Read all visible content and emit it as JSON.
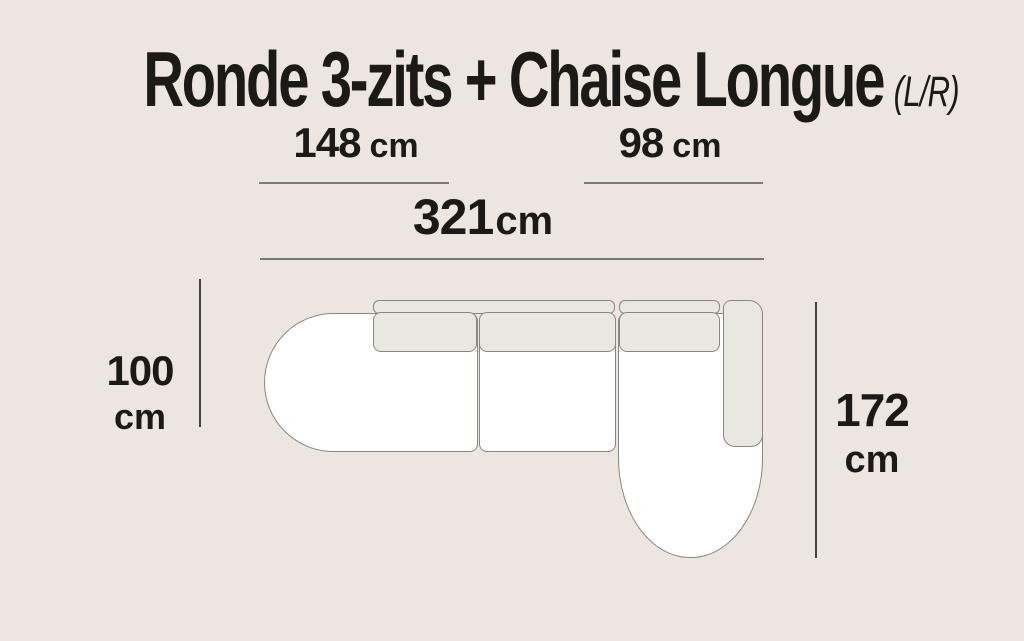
{
  "title": {
    "main": "Ronde 3-zits + Chaise Longue",
    "suffix": "(L/R)"
  },
  "measurements": {
    "left_section_width": {
      "value": "148",
      "unit": "cm"
    },
    "chaise_section_width": {
      "value": "98",
      "unit": "cm"
    },
    "total_width": {
      "value": "321",
      "unit": "cm"
    },
    "sofa_depth": {
      "value": "100",
      "unit": "cm"
    },
    "chaise_length": {
      "value": "172",
      "unit": "cm"
    }
  },
  "colors": {
    "bg": "#EDE5E0",
    "seat-fill": "#FFFFFF",
    "cushion-fill": "#E9E7E2",
    "stroke": "#8A8680",
    "ink": "#1C1A17",
    "line-h": "#7D7872",
    "line-v": "#474440"
  }
}
